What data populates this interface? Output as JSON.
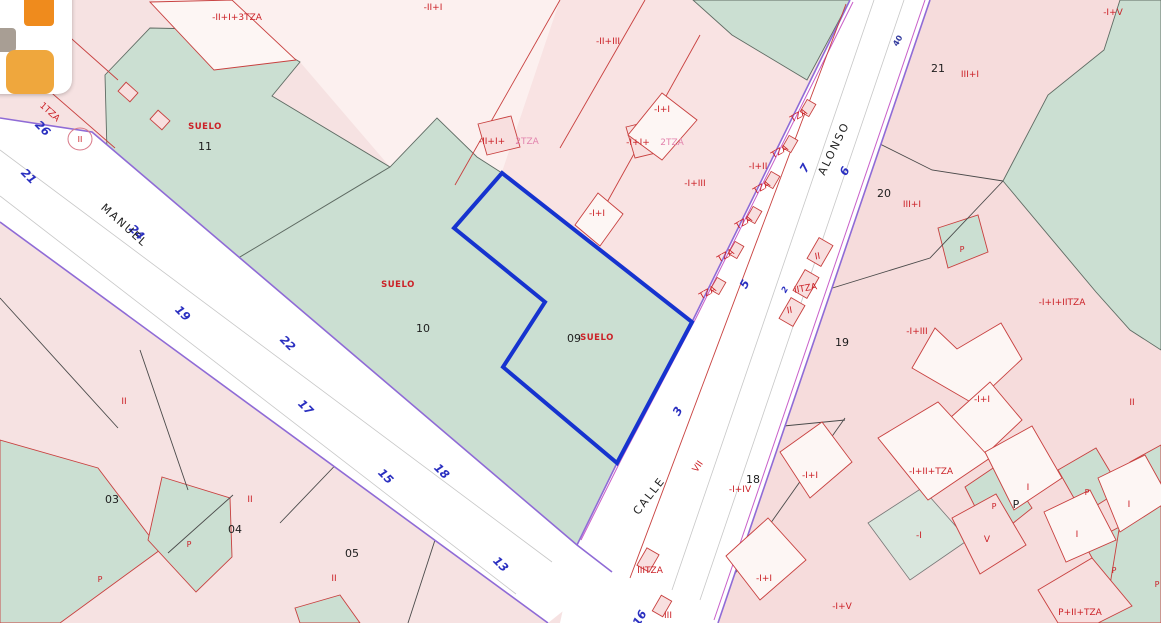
{
  "map": {
    "selected_parcel": {
      "id_label": "09",
      "land_label": "SUELO"
    },
    "colors": {
      "parcel_pink": "#f6dcdc",
      "parcel_pale": "#fcf0ef",
      "parcel_green": "#cbdfd2",
      "street_white": "#ffffff",
      "highlight_blue": "#1633cf",
      "boundary_red": "#c8403f",
      "street_edge_purple": "#8f6bd6",
      "label_red": "#cb2127",
      "label_blue": "#2a2fc0"
    },
    "labels": [
      {
        "t": "-II+I+3TZA",
        "x": 237,
        "y": 20,
        "c": "red"
      },
      {
        "t": "-II+I",
        "x": 433,
        "y": 10,
        "c": "red"
      },
      {
        "t": "-II+III",
        "x": 608,
        "y": 44,
        "c": "red"
      },
      {
        "t": "-I+V",
        "x": 1113,
        "y": 15,
        "c": "red"
      },
      {
        "t": "2TZA",
        "x": 20,
        "y": 84,
        "c": "red",
        "r": 42
      },
      {
        "t": "1TZA",
        "x": 48,
        "y": 114,
        "c": "red",
        "r": 42
      },
      {
        "t": "II",
        "x": 80,
        "y": 142,
        "c": "redsm"
      },
      {
        "t": "SUELO",
        "x": 205,
        "y": 129,
        "c": "suelo"
      },
      {
        "t": "11",
        "x": 205,
        "y": 150,
        "c": "black"
      },
      {
        "t": "-II+I+",
        "x": 492,
        "y": 144,
        "c": "red"
      },
      {
        "t": "2TZA",
        "x": 527,
        "y": 144,
        "c": "pink"
      },
      {
        "t": "-I+I",
        "x": 662,
        "y": 112,
        "c": "red"
      },
      {
        "t": "-I+I+",
        "x": 638,
        "y": 145,
        "c": "red"
      },
      {
        "t": "2TZA",
        "x": 672,
        "y": 145,
        "c": "pink"
      },
      {
        "t": "-I+III",
        "x": 695,
        "y": 186,
        "c": "red"
      },
      {
        "t": "-I+II",
        "x": 758,
        "y": 169,
        "c": "red"
      },
      {
        "t": "TZA",
        "x": 800,
        "y": 118,
        "c": "red",
        "r": -30
      },
      {
        "t": "TZA",
        "x": 781,
        "y": 154,
        "c": "red",
        "r": -30
      },
      {
        "t": "TZA",
        "x": 763,
        "y": 190,
        "c": "red",
        "r": -30
      },
      {
        "t": "TZA",
        "x": 745,
        "y": 225,
        "c": "red",
        "r": -30
      },
      {
        "t": "TZA",
        "x": 727,
        "y": 258,
        "c": "red",
        "r": -30
      },
      {
        "t": "TZA",
        "x": 709,
        "y": 295,
        "c": "red",
        "r": -30
      },
      {
        "t": "21",
        "x": 938,
        "y": 72,
        "c": "black"
      },
      {
        "t": "III+I",
        "x": 970,
        "y": 77,
        "c": "red"
      },
      {
        "t": "20",
        "x": 884,
        "y": 197,
        "c": "black"
      },
      {
        "t": "III+I",
        "x": 912,
        "y": 207,
        "c": "red"
      },
      {
        "t": "-I+I",
        "x": 597,
        "y": 216,
        "c": "red"
      },
      {
        "t": "SUELO",
        "x": 398,
        "y": 287,
        "c": "suelo"
      },
      {
        "t": "10",
        "x": 423,
        "y": 332,
        "c": "black"
      },
      {
        "t": "09",
        "x": 574,
        "y": 342,
        "c": "black"
      },
      {
        "t": "SUELO",
        "x": 597,
        "y": 340,
        "c": "suelo"
      },
      {
        "t": "-I+I+IITZA",
        "x": 1062,
        "y": 305,
        "c": "red"
      },
      {
        "t": "-I+III",
        "x": 917,
        "y": 334,
        "c": "red"
      },
      {
        "t": "19",
        "x": 842,
        "y": 346,
        "c": "black"
      },
      {
        "t": "-I+I",
        "x": 982,
        "y": 402,
        "c": "red"
      },
      {
        "t": "II",
        "x": 1132,
        "y": 405,
        "c": "red"
      },
      {
        "t": "II",
        "x": 818,
        "y": 259,
        "c": "red",
        "r": -10
      },
      {
        "t": "IITZA",
        "x": 806,
        "y": 291,
        "c": "red",
        "r": -10
      },
      {
        "t": "II",
        "x": 790,
        "y": 313,
        "c": "red",
        "r": -10
      },
      {
        "t": "VII",
        "x": 700,
        "y": 468,
        "c": "red",
        "r": -55
      },
      {
        "t": "18",
        "x": 753,
        "y": 483,
        "c": "black"
      },
      {
        "t": "-I+IV",
        "x": 740,
        "y": 492,
        "c": "red"
      },
      {
        "t": "-I+I",
        "x": 810,
        "y": 478,
        "c": "red"
      },
      {
        "t": "-I+I",
        "x": 764,
        "y": 581,
        "c": "red"
      },
      {
        "t": "-I+V",
        "x": 842,
        "y": 609,
        "c": "red"
      },
      {
        "t": "IIITZA",
        "x": 650,
        "y": 573,
        "c": "red"
      },
      {
        "t": "III",
        "x": 668,
        "y": 618,
        "c": "red"
      },
      {
        "t": "-I+II+TZA",
        "x": 931,
        "y": 474,
        "c": "red"
      },
      {
        "t": "-I",
        "x": 919,
        "y": 538,
        "c": "red"
      },
      {
        "t": "V",
        "x": 987,
        "y": 542,
        "c": "red"
      },
      {
        "t": "I",
        "x": 1028,
        "y": 490,
        "c": "red"
      },
      {
        "t": "I",
        "x": 1129,
        "y": 507,
        "c": "red"
      },
      {
        "t": "I",
        "x": 1077,
        "y": 537,
        "c": "red"
      },
      {
        "t": "P",
        "x": 1016,
        "y": 508,
        "c": "black"
      },
      {
        "t": "P",
        "x": 994,
        "y": 509,
        "c": "redsm"
      },
      {
        "t": "P",
        "x": 1087,
        "y": 495,
        "c": "redsm"
      },
      {
        "t": "P",
        "x": 1114,
        "y": 573,
        "c": "redsm"
      },
      {
        "t": "P",
        "x": 962,
        "y": 252,
        "c": "redsm"
      },
      {
        "t": "P",
        "x": 100,
        "y": 582,
        "c": "redsm"
      },
      {
        "t": "P",
        "x": 189,
        "y": 547,
        "c": "redsm"
      },
      {
        "t": "P",
        "x": 1157,
        "y": 587,
        "c": "redsm"
      },
      {
        "t": "P+II+TZA",
        "x": 1080,
        "y": 615,
        "c": "red"
      },
      {
        "t": "03",
        "x": 112,
        "y": 503,
        "c": "black"
      },
      {
        "t": "04",
        "x": 235,
        "y": 533,
        "c": "black"
      },
      {
        "t": "05",
        "x": 352,
        "y": 557,
        "c": "black"
      },
      {
        "t": "II",
        "x": 124,
        "y": 404,
        "c": "red"
      },
      {
        "t": "II",
        "x": 250,
        "y": 502,
        "c": "red"
      },
      {
        "t": "II",
        "x": 334,
        "y": 581,
        "c": "red"
      },
      {
        "t": "40",
        "x": 900,
        "y": 42,
        "c": "navy",
        "r": -60
      },
      {
        "t": "26",
        "x": 40,
        "y": 131,
        "c": "blue",
        "r": 45
      },
      {
        "t": "21",
        "x": 26,
        "y": 179,
        "c": "blue",
        "r": 45
      },
      {
        "t": "24",
        "x": 134,
        "y": 235,
        "c": "blue",
        "r": 45
      },
      {
        "t": "19",
        "x": 180,
        "y": 316,
        "c": "blue",
        "r": 45
      },
      {
        "t": "22",
        "x": 285,
        "y": 346,
        "c": "blue",
        "r": 45
      },
      {
        "t": "17",
        "x": 303,
        "y": 410,
        "c": "blue",
        "r": 45
      },
      {
        "t": "15",
        "x": 383,
        "y": 479,
        "c": "blue",
        "r": 45
      },
      {
        "t": "18",
        "x": 439,
        "y": 474,
        "c": "blue",
        "r": 45
      },
      {
        "t": "13",
        "x": 498,
        "y": 567,
        "c": "blue",
        "r": 45
      },
      {
        "t": "16",
        "x": 643,
        "y": 620,
        "c": "blue",
        "r": -60
      },
      {
        "t": "7",
        "x": 808,
        "y": 170,
        "c": "blue",
        "r": -60
      },
      {
        "t": "6",
        "x": 848,
        "y": 173,
        "c": "blue",
        "r": -60
      },
      {
        "t": "5",
        "x": 748,
        "y": 286,
        "c": "blue",
        "r": -60
      },
      {
        "t": "3",
        "x": 681,
        "y": 413,
        "c": "blue",
        "r": -60
      },
      {
        "t": "2",
        "x": 787,
        "y": 291,
        "c": "bluesm",
        "r": -60
      },
      {
        "t": "MANUEL",
        "x": 122,
        "y": 228,
        "c": "street",
        "r": 42
      },
      {
        "t": "CALLE",
        "x": 652,
        "y": 498,
        "c": "street",
        "r": -52
      },
      {
        "t": "ALONSO",
        "x": 837,
        "y": 150,
        "c": "street",
        "r": -64
      }
    ]
  },
  "logo": {
    "name": "app-logo"
  }
}
